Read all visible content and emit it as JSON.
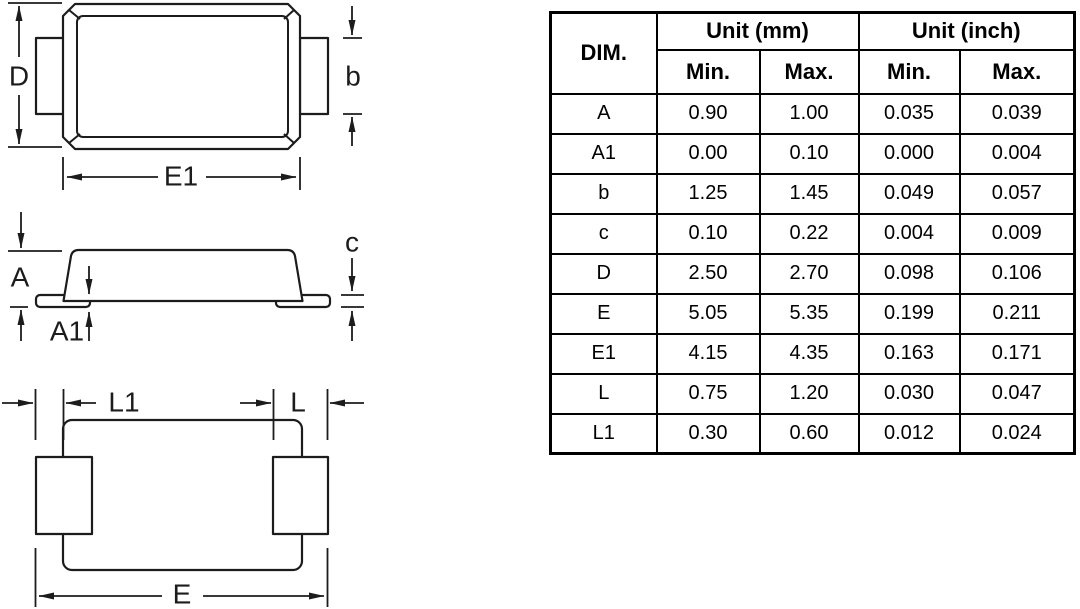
{
  "colors": {
    "ink": "#1c1c1c",
    "tbl": "#000000",
    "bg": "#ffffff"
  },
  "drawing": {
    "top_view": {
      "dim_d": "D",
      "dim_b": "b",
      "dim_e1": "E1"
    },
    "side_view": {
      "dim_a": "A",
      "dim_a1": "A1",
      "dim_c": "c"
    },
    "bottom_view": {
      "dim_l1": "L1",
      "dim_l": "L",
      "dim_e": "E"
    }
  },
  "table": {
    "col_dim": "DIM.",
    "group_mm": "Unit (mm)",
    "group_inch": "Unit (inch)",
    "min_label": "Min.",
    "max_label": "Max.",
    "rows": [
      {
        "dim": "A",
        "mm_min": "0.90",
        "mm_max": "1.00",
        "in_min": "0.035",
        "in_max": "0.039"
      },
      {
        "dim": "A1",
        "mm_min": "0.00",
        "mm_max": "0.10",
        "in_min": "0.000",
        "in_max": "0.004"
      },
      {
        "dim": "b",
        "mm_min": "1.25",
        "mm_max": "1.45",
        "in_min": "0.049",
        "in_max": "0.057"
      },
      {
        "dim": "c",
        "mm_min": "0.10",
        "mm_max": "0.22",
        "in_min": "0.004",
        "in_max": "0.009"
      },
      {
        "dim": "D",
        "mm_min": "2.50",
        "mm_max": "2.70",
        "in_min": "0.098",
        "in_max": "0.106"
      },
      {
        "dim": "E",
        "mm_min": "5.05",
        "mm_max": "5.35",
        "in_min": "0.199",
        "in_max": "0.211"
      },
      {
        "dim": "E1",
        "mm_min": "4.15",
        "mm_max": "4.35",
        "in_min": "0.163",
        "in_max": "0.171"
      },
      {
        "dim": "L",
        "mm_min": "0.75",
        "mm_max": "1.20",
        "in_min": "0.030",
        "in_max": "0.047"
      },
      {
        "dim": "L1",
        "mm_min": "0.30",
        "mm_max": "0.60",
        "in_min": "0.012",
        "in_max": "0.024"
      }
    ]
  }
}
